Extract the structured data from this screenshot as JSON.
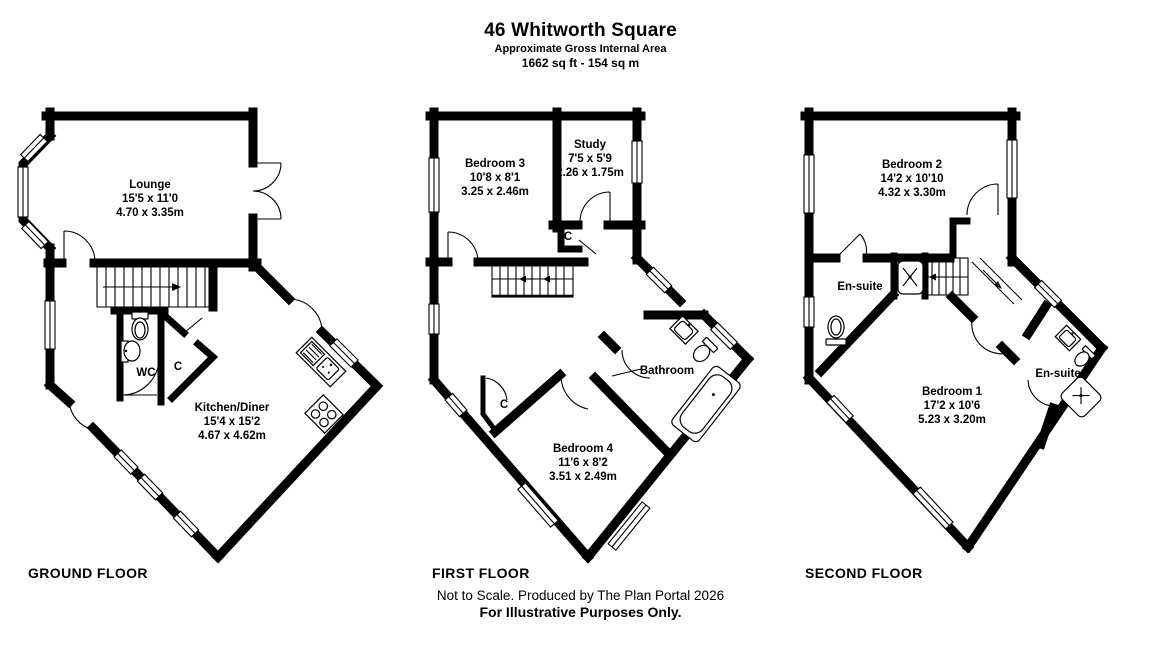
{
  "header": {
    "title": "46 Whitworth Square",
    "subtitle": "Approximate Gross Internal Area",
    "area": "1662 sq ft - 154 sq m"
  },
  "floors": [
    {
      "id": "ground",
      "label": "GROUND FLOOR",
      "rooms": [
        {
          "name": "Lounge",
          "imperial": "15'5 x 11'0",
          "metric": "4.70 x 3.35m"
        },
        {
          "name": "WC"
        },
        {
          "name": "C"
        },
        {
          "name": "Kitchen/Diner",
          "imperial": "15'4 x 15'2",
          "metric": "4.67 x 4.62m"
        }
      ]
    },
    {
      "id": "first",
      "label": "FIRST FLOOR",
      "rooms": [
        {
          "name": "Bedroom 3",
          "imperial": "10'8 x 8'1",
          "metric": "3.25 x 2.46m"
        },
        {
          "name": "Study",
          "imperial": "7'5 x 5'9",
          "metric": "2.26 x 1.75m"
        },
        {
          "name": "C"
        },
        {
          "name": "Bathroom"
        },
        {
          "name": "C"
        },
        {
          "name": "Bedroom 4",
          "imperial": "11'6 x 8'2",
          "metric": "3.51 x 2.49m"
        }
      ]
    },
    {
      "id": "second",
      "label": "SECOND FLOOR",
      "rooms": [
        {
          "name": "Bedroom 2",
          "imperial": "14'2 x 10'10",
          "metric": "4.32 x 3.30m"
        },
        {
          "name": "En-suite"
        },
        {
          "name": "En-suite"
        },
        {
          "name": "Bedroom 1",
          "imperial": "17'2 x 10'6",
          "metric": "5.23 x 3.20m"
        }
      ]
    }
  ],
  "footer": {
    "line1": "Not to Scale. Produced by The Plan Portal 2026",
    "line2": "For Illustrative Purposes Only."
  },
  "colors": {
    "wall": "#000000",
    "background": "#ffffff"
  }
}
